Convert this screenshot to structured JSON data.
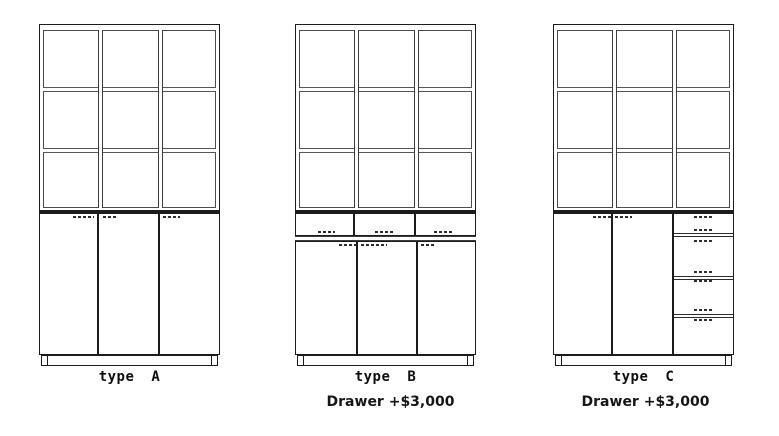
{
  "page": {
    "background_color": "#ffffff",
    "line_color": "#1c1c1c",
    "text_color": "#101010"
  },
  "cabinets": [
    {
      "id": "A",
      "label": "type A",
      "note": null,
      "structure": {
        "upper": {
          "type": "open-shelf-grid",
          "columns": 3,
          "rows": 3
        },
        "lower": {
          "doors": 3,
          "drawers": 0
        },
        "base": "plinth"
      }
    },
    {
      "id": "B",
      "label": "type B",
      "note": "Drawer +$3,000",
      "structure": {
        "upper": {
          "type": "open-shelf-grid",
          "columns": 3,
          "rows": 3
        },
        "lower": {
          "doors": 3,
          "drawers": 3,
          "drawer_layout": "one row of 3 drawers above doors"
        },
        "base": "plinth"
      }
    },
    {
      "id": "C",
      "label": "type C",
      "note": "Drawer +$3,000",
      "structure": {
        "upper": {
          "type": "open-shelf-grid",
          "columns": 3,
          "rows": 3
        },
        "lower": {
          "doors": 2,
          "drawers": 4,
          "drawer_layout": "vertical stack of 4 drawers on right third"
        },
        "base": "plinth"
      }
    }
  ]
}
